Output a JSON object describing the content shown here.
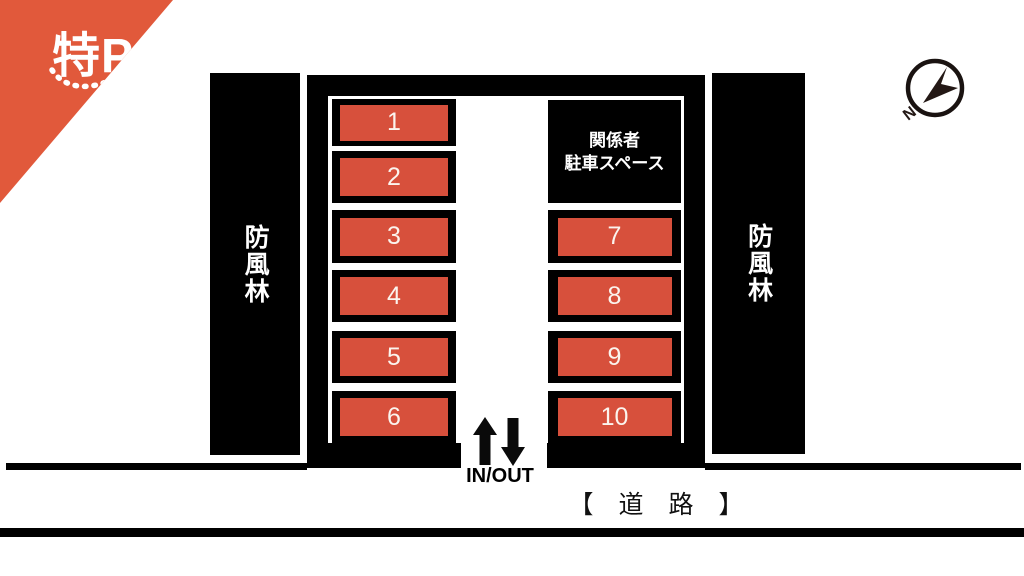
{
  "brand": {
    "logo_text": "特P"
  },
  "compass": {
    "north_label": "N"
  },
  "windbreaks": {
    "left": "防風林",
    "right": "防風林"
  },
  "staff_area": {
    "line1": "関係者",
    "line2": "駐車スペース"
  },
  "parking": {
    "left_spots": [
      "1",
      "2",
      "3",
      "4",
      "5",
      "6"
    ],
    "right_spots": [
      "7",
      "8",
      "9",
      "10"
    ]
  },
  "entrance": {
    "label": "IN/OUT"
  },
  "road": {
    "label": "【　道　路　】"
  },
  "colors": {
    "spot_orange": "#D7503C",
    "logo_orange": "#E1593B",
    "needle_dark": "#231815",
    "black": "#000000"
  }
}
